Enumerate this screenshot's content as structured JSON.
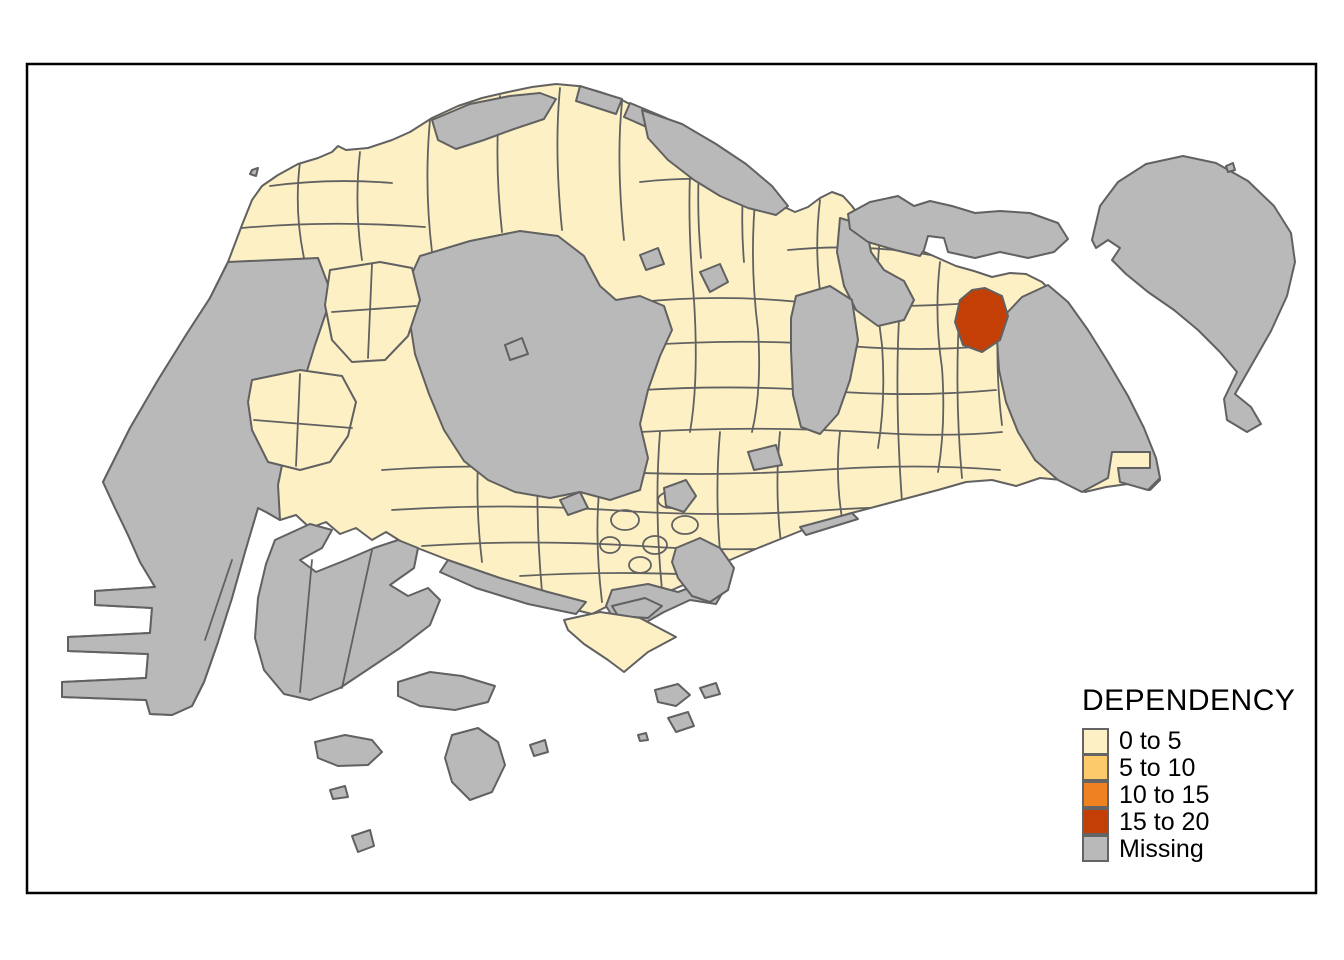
{
  "legend": {
    "title": "DEPENDENCY",
    "items": [
      {
        "label": "0 to 5",
        "color": "#FDF0C4"
      },
      {
        "label": "5 to 10",
        "color": "#FCC96B"
      },
      {
        "label": "10 to 15",
        "color": "#EF8123"
      },
      {
        "label": "15 to 20",
        "color": "#C33F05"
      },
      {
        "label": "Missing",
        "color": "#B9B9B9"
      }
    ],
    "swatch_border_color": "#646464"
  },
  "map": {
    "colors": {
      "band_0_5": "#FDF0C4",
      "band_5_10": "#FCC96B",
      "band_10_15": "#EF8123",
      "band_15_20": "#C33F05",
      "missing": "#B9B9B9",
      "region_border": "#616161",
      "frame_border": "#000000",
      "sea_background": "#FFFFFF"
    },
    "visible_classes_on_map": [
      "0 to 5",
      "15 to 20",
      "Missing"
    ],
    "highlighted_region_class": "15 to 20"
  }
}
